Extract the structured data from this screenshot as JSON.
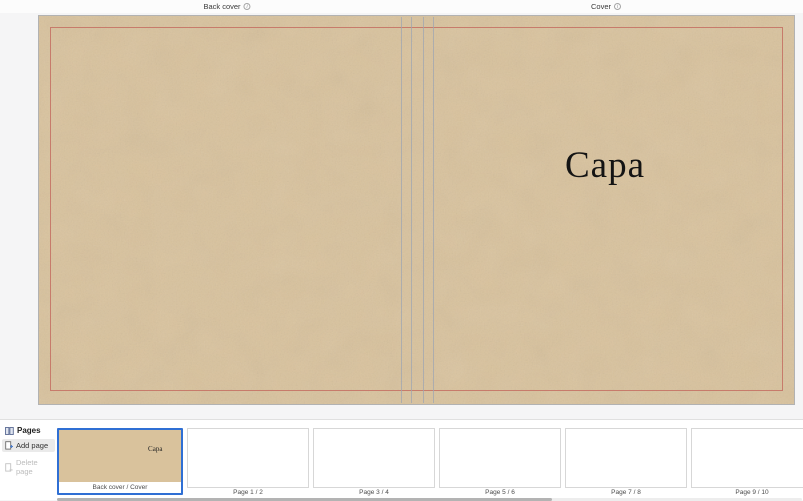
{
  "top_bar": {
    "back_cover_label": "Back cover",
    "cover_label": "Cover",
    "info_icon_glyph": "i"
  },
  "canvas": {
    "cover_title": "Capa",
    "leather_color": "#d9c29c",
    "trim_line_color": "#c46e62",
    "spine_line_color": "#9fa6b2",
    "selection_color": "#2f6fd4"
  },
  "pages_panel": {
    "title": "Pages",
    "add_page_label": "Add page",
    "delete_page_label": "Delete page",
    "thumbnails": [
      {
        "label": "Back cover / Cover",
        "selected": true,
        "kind": "cover",
        "title": "Capa"
      },
      {
        "label": "Page 1 / 2",
        "selected": false,
        "kind": "blank"
      },
      {
        "label": "Page 3 / 4",
        "selected": false,
        "kind": "blank"
      },
      {
        "label": "Page 5 / 6",
        "selected": false,
        "kind": "blank"
      },
      {
        "label": "Page 7 / 8",
        "selected": false,
        "kind": "blank"
      },
      {
        "label": "Page 9 / 10",
        "selected": false,
        "kind": "blank"
      }
    ]
  }
}
